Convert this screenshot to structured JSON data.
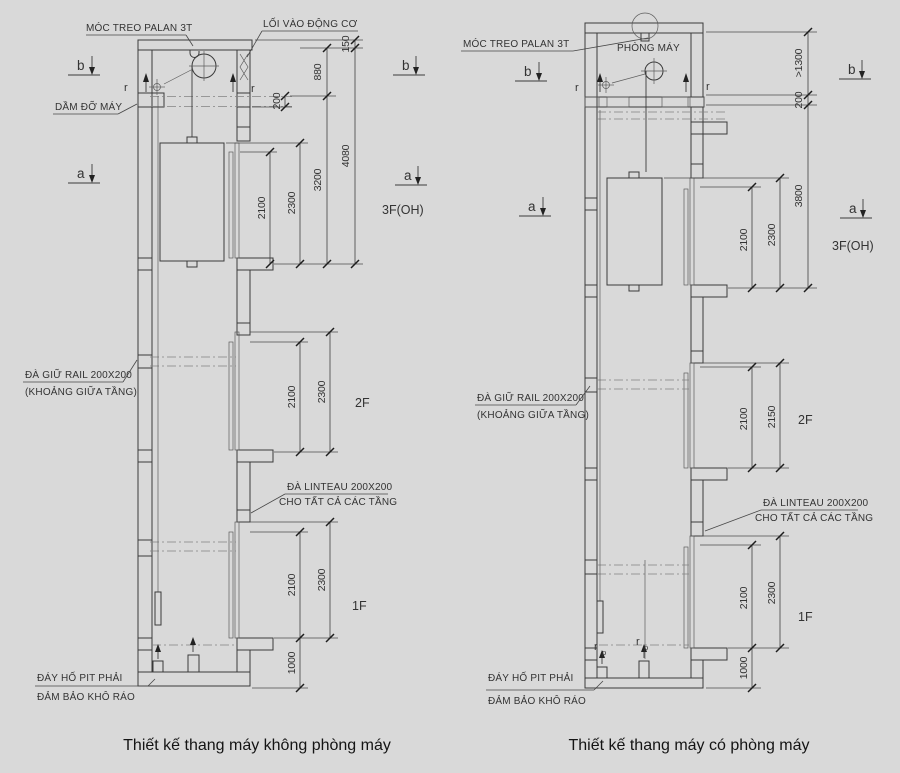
{
  "colors": {
    "background": "#d9d9d9",
    "line": "#3a3a3a",
    "text": "#333333"
  },
  "left": {
    "caption": "Thiết kế thang máy không phòng máy",
    "callouts": {
      "hook": "MÓC TREO PALAN 3T",
      "motor_access": "LỐI VÀO ĐỘNG CƠ",
      "machine_beam": "DẦM ĐỠ MÁY",
      "rail1": "ĐÀ GIỮ RAIL 200X200",
      "rail2": "(KHOẢNG GIỮA TẦNG)",
      "linteau1": "ĐÀ LINTEAU 200X200",
      "linteau2": "CHO TẤT CẢ CÁC TẦNG",
      "pit1": "ĐÁY HỐ PIT PHẢI",
      "pit2": "ĐẢM BẢO KHÔ RÁO"
    },
    "floors": {
      "f3": "3F(OH)",
      "f2": "2F",
      "f1": "1F"
    },
    "sections": {
      "b": "b",
      "a": "a"
    },
    "rail_mark": "r",
    "dims": {
      "d150": "150",
      "d880": "880",
      "d200": "200",
      "d4080": "4080",
      "d3200": "3200",
      "top_2300": "2300",
      "top_2100": "2100",
      "f2_2100": "2100",
      "f2_2300": "2300",
      "f1_2100": "2100",
      "f1_2300": "2300",
      "d1000": "1000"
    }
  },
  "right": {
    "caption": "Thiết kế thang máy có phòng máy",
    "callouts": {
      "hook": "MÓC TREO PALAN 3T",
      "machine_room": "PHÒNG MÁY",
      "rail1": "ĐÀ GIỮ RAIL 200X200",
      "rail2": "(KHOẢNG GIỮA TẦNG)",
      "linteau1": "ĐÀ LINTEAU 200X200",
      "linteau2": "CHO TẤT CẢ CÁC TẦNG",
      "pit1": "ĐÁY HỐ PIT PHẢI",
      "pit2": "ĐẢM BẢO KHÔ RÁO"
    },
    "floors": {
      "f3": "3F(OH)",
      "f2": "2F",
      "f1": "1F"
    },
    "sections": {
      "b": "b",
      "a": "a"
    },
    "rail_mark": "r",
    "buffer_mark": {
      "r": "r",
      "p": "p"
    },
    "dims": {
      "d1300": ">1300",
      "d200": "200",
      "d3800": "3800",
      "top_2300": "2300",
      "top_2100": "2100",
      "f2_2100": "2100",
      "f2_2150": "2150",
      "f1_2100": "2100",
      "f1_2300": "2300",
      "d1000": "1000"
    }
  }
}
